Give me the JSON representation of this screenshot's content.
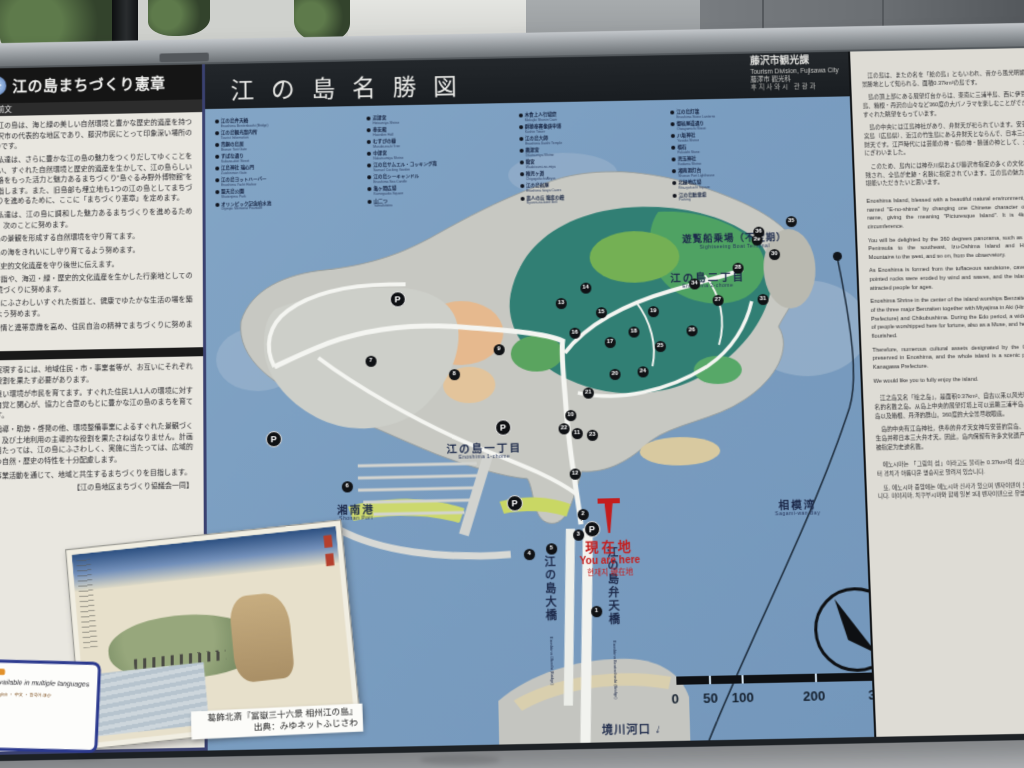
{
  "colors": {
    "sea": "#7a9dc0",
    "band_dark": "#1b1f23",
    "accent_red": "#c41d1d",
    "navy_text": "#1d2a4a",
    "paper": "#e9e7e0"
  },
  "left_panel": {
    "emblem": "❉",
    "title": "江の島まちづくり憲章",
    "section_label": "1　前文",
    "preamble": [
      "　江の島は、海と緑の美しい自然環境と豊かな歴史的遺産を持つ藤沢市の代表的な地区であり、藤沢市民にとって印象深い場所の1つです。",
      "　私達は、さらに豊かな江の島の魅力をつくりだしてゆくことを願い、すぐれた自然環境と歴史的遺産を生かして、江の島らしい風格をもった活力と魅力あるまちづくり“島ぐるみ野外博物館”を目指します。また、旧島部も埋立地も1つの江の島としてまちづくりを進めるために、ここに「まちづくり憲章」を定めます。",
      "　私達は、江の島に調和した魅力あるまちづくりを進めるために、次のことに努めます。"
    ],
    "goals": [
      "●島の景観を形成する自然環境を守り育てます。",
      "●島の海をきれいにし守り育てるよう努めます。",
      "●歴史的文化遺産を守り後世に伝えます。",
      "●参詣や、海辺・緑・歴史的文化遺産を生かした行楽地としての環境づくりに努めます。",
      "●島にふさわしいすぐれた街並と、健康でゆたかな生活の場を築くよう努めます。",
      "●愛情と連帯意識を高め、住民自治の精神でまちづくりに努めます。"
    ],
    "section2": [
      "　実現するには、地域住民・市・事業者等が、お互いにそれぞれの役割を果たす必要があります。",
      "　良い環境が市民を育てます。すぐれた住民1人1人の環境に対する自覚と関心が、協力と合意のもとに豊かな江の島のまちを育てます。",
      "　指導・助勢・啓発の他、環境整備事業によるすぐれた景観づくり、及び土地利用の主導的な役割を果たさねばなりません。計画に当たっては、江の島にふさわしく、実施に当たっては、広域的かつ自然・歴史の特性を十分配慮します。",
      "　事業活動を通じて、地域と共生するまちづくりを目指します。"
    ],
    "signature": "【江の島地区まちづくり協議会一同】",
    "multilingual_box": {
      "line1": "Available in multiple languages",
      "line2": "English ・ 中文 ・ 한국어 ほか"
    }
  },
  "map_panel": {
    "title": "江の島名勝図",
    "credits": {
      "jp": "藤沢市観光課",
      "en": "Tourism Division, Fujisawa City",
      "zh": "藤澤市 觀光科",
      "kr": "후지사와시  관광과"
    },
    "legend": {
      "columns": [
        {
          "items": [
            {
              "jp": "江の島弁天橋",
              "en": "Enoshima Bentenbashi (Bridge)"
            },
            {
              "jp": "江の島観光案内所",
              "en": "Tourist Information"
            },
            {
              "jp": "青銅の鳥居",
              "en": "Bronze Torii Gate"
            },
            {
              "jp": "すばな通り",
              "en": "Subana-dori Street"
            },
            {
              "jp": "江島神社 瑞心門",
              "en": "Zuishinmon Gate"
            },
            {
              "jp": "江の島ヨットハーバー",
              "en": "Enoshima Yacht Harbor"
            },
            {
              "jp": "聖天島公園",
              "en": "Shotenjima Park"
            },
            {
              "jp": "オリンピック記念噴水池",
              "en": "Olympic Memorial Fountain"
            }
          ]
        },
        {
          "items": [
            {
              "jp": "辺津宮",
              "en": "Hetsumiya Shrine"
            },
            {
              "jp": "奉安殿",
              "en": "Hoanden Hall"
            },
            {
              "jp": "むすびの樹",
              "en": "Musubi-no-ki Tree"
            },
            {
              "jp": "中津宮",
              "en": "Nakatsumiya Shrine"
            },
            {
              "jp": "江の島サムエル・コッキング苑",
              "en": "Samuel Cocking Garden"
            },
            {
              "jp": "江の島シーキャンドル",
              "en": "Enoshima Sea Candle"
            },
            {
              "jp": "亀ヶ岡広場",
              "en": "Kamegaoka Square"
            },
            {
              "jp": "山二つ",
              "en": "Yamafutatsu"
            }
          ]
        },
        {
          "items": [
            {
              "jp": "木食上人行場窟",
              "en": "Mokujiki Shonin Cave"
            },
            {
              "jp": "群猿奉賽像庚申塔",
              "en": "Koshin Tower"
            },
            {
              "jp": "江の島大師",
              "en": "Enoshima Daishi Temple"
            },
            {
              "jp": "奥津宮",
              "en": "Okutsumiya Shrine"
            },
            {
              "jp": "龍宮",
              "en": "Wadatsumi-no-miya"
            },
            {
              "jp": "稚児ヶ淵",
              "en": "Chigogafuchi Abyss"
            },
            {
              "jp": "江の島岩屋",
              "en": "Enoshima Iwaya Caves"
            },
            {
              "jp": "恋人の丘 龍恋の鐘",
              "en": "Ryuren-no-kane Bell"
            }
          ]
        },
        {
          "items": [
            {
              "jp": "江の島灯籠",
              "en": "Enoshima Stone Lanterns"
            },
            {
              "jp": "御岩屋道通り",
              "en": "Oiwayamichi Street"
            },
            {
              "jp": "八坂神社",
              "en": "Yasaka Shrine"
            },
            {
              "jp": "福石",
              "en": "Fukuishi Stone"
            },
            {
              "jp": "児玉神社",
              "en": "Kodama Shrine"
            },
            {
              "jp": "湘南港灯台",
              "en": "Shonan Port Lighthouse"
            },
            {
              "jp": "北緑地広場",
              "en": "Kita-ryokuchi Square"
            },
            {
              "jp": "江の島駐車場",
              "en": "Parking"
            }
          ]
        }
      ]
    },
    "labels": {
      "district1": {
        "jp": "江の島一丁目",
        "en": "Enoshima 1-chome"
      },
      "district2": {
        "jp": "江の島二丁目",
        "en": "Enoshima 2-chome"
      },
      "port": {
        "jp": "湘南港",
        "en": "Shonan Port"
      },
      "bay": {
        "jp": "相模湾",
        "en": "Sagami-wan Bay"
      },
      "boat": {
        "jp": "遊覧船乗場（不定期）",
        "en": "Sightseeing Boat Terminal"
      },
      "river": {
        "jp": "境川河口",
        "arrow": "↓"
      },
      "bridge_left": {
        "jp": "江の島大橋",
        "en": "Enoshima Ohashi (Bridge)"
      },
      "bridge_right": {
        "jp": "江の島弁天橋",
        "en": "Enoshima Bentenbashi (Bridge)"
      }
    },
    "you_are_here": {
      "jp": "現在地",
      "en": "You are here",
      "multi": "현재지  現在地"
    },
    "compass_label": "N",
    "scale": {
      "ticks": [
        {
          "t": "0",
          "x": 455
        },
        {
          "t": "50",
          "x": 486
        },
        {
          "t": "100",
          "x": 514
        },
        {
          "t": "200",
          "x": 584
        },
        {
          "t": "300m",
          "x": 648
        }
      ]
    },
    "parking_label": "P",
    "markers": [
      {
        "n": "1",
        "x": 378,
        "y": 550
      },
      {
        "n": "2",
        "x": 367,
        "y": 455
      },
      {
        "n": "3",
        "x": 362,
        "y": 475
      },
      {
        "n": "4",
        "x": 313,
        "y": 493
      },
      {
        "n": "5",
        "x": 335,
        "y": 488
      },
      {
        "n": "6",
        "x": 134,
        "y": 423
      },
      {
        "n": "7",
        "x": 159,
        "y": 299
      },
      {
        "n": "8",
        "x": 242,
        "y": 314
      },
      {
        "n": "9",
        "x": 287,
        "y": 290
      },
      {
        "n": "10",
        "x": 357,
        "y": 357
      },
      {
        "n": "11",
        "x": 363,
        "y": 375
      },
      {
        "n": "12",
        "x": 360,
        "y": 415
      },
      {
        "n": "13",
        "x": 350,
        "y": 245
      },
      {
        "n": "14",
        "x": 375,
        "y": 230
      },
      {
        "n": "15",
        "x": 390,
        "y": 255
      },
      {
        "n": "16",
        "x": 363,
        "y": 275
      },
      {
        "n": "17",
        "x": 398,
        "y": 285
      },
      {
        "n": "18",
        "x": 422,
        "y": 275
      },
      {
        "n": "19",
        "x": 442,
        "y": 255
      },
      {
        "n": "20",
        "x": 402,
        "y": 317
      },
      {
        "n": "21",
        "x": 375,
        "y": 335
      },
      {
        "n": "22",
        "x": 350,
        "y": 370
      },
      {
        "n": "23",
        "x": 378,
        "y": 377
      },
      {
        "n": "24",
        "x": 430,
        "y": 315
      },
      {
        "n": "25",
        "x": 448,
        "y": 290
      },
      {
        "n": "26",
        "x": 480,
        "y": 275
      },
      {
        "n": "27",
        "x": 507,
        "y": 245
      },
      {
        "n": "28",
        "x": 528,
        "y": 213
      },
      {
        "n": "29",
        "x": 548,
        "y": 185
      },
      {
        "n": "30",
        "x": 565,
        "y": 200
      },
      {
        "n": "31",
        "x": 552,
        "y": 245
      },
      {
        "n": "34",
        "x": 484,
        "y": 228
      },
      {
        "n": "35",
        "x": 583,
        "y": 167
      },
      {
        "n": "36",
        "x": 550,
        "y": 177
      }
    ],
    "parking": [
      {
        "label": "P",
        "x": 184,
        "y": 235
      },
      {
        "label": "P",
        "x": 59,
        "y": 372
      },
      {
        "label": "P",
        "x": 287,
        "y": 365
      },
      {
        "label": "P",
        "x": 297,
        "y": 440
      },
      {
        "label": "P",
        "x": 373,
        "y": 467
      }
    ]
  },
  "ukiyoe": {
    "caption_line1": "葛飾北斎『冨嶽三十六景 相州江の島』",
    "caption_line2": "出典：みゆネットふじさわ"
  },
  "right_panel": {
    "jp": [
      "　江の島は、またの名を「絵の島」ともいわれ、昔から風光明媚な景勝地として知られる、面積0.37km²の島です。",
      "　島の頂上部にある展望灯台からは、東南に三浦半島、西に伊豆大島、箱根・丹沢の山々など360度の大パノラマを楽しむことができ、すぐれた眺望をもっています。",
      "　島の中央には江島神社があり、弁財天が祀られています。安芸の宮島（広島県）、近江の竹生島にある弁財天とならんで、日本三大弁財天です。江戸時代には芸能の神・福の神・勝運の神として、大変にぎわいました。",
      "　このため、島内には神奈川県および藤沢市指定の多くの文化財が残され、全島が史跡・名勝に指定されています。江の島の魅力をご堪能いただきたいと思います。"
    ],
    "en": [
      "Enoshima Island, blessed with a beautiful natural environment, was named \"E-no-shima\" by changing one Chinese character of the name, giving the meaning \"Picturesque Island\". It is 4km in circumference.",
      "You will be delighted by the 360 degrees panorama, such as Miura Peninsula to the southeast, Izu-Oshima Island and Hakone Mountains to the west, and so on, from the observatory.",
      "As Enoshima is formed from the tuffaceous sandstone, caves and pointed rocks were eroded by wind and waves, and the island has attracted people for ages.",
      "Enoshima Shrine in the center of the island worships Benzaiten, one of the three major Benzaiten together with Miyajima in Aki (Hiroshima Prefecture) and Chikubushima. During the Edo period, a wide range of people worshipped here for fortune, also as a Muse, and here they flourished.",
      "Therefore, numerous cultural assets designated by the City are preserved in Enoshima, and the whole island is a scenic place by Kanagawa Prefecture.",
      "We would like you to fully enjoy the island."
    ],
    "zh": [
      "　江之岛又名「绘之岛」，是面积0.37km²、自古以来以风光明媚而闻名的名胜之岛。从岛上中央的展望灯塔上可以远眺三浦半岛、伊豆大岛以及箱根、丹泽的群山，360度的大全景尽收眼底。",
      "　岛的中央有江岛神社，供奉的弁才天女神与安芸的宫岛、近江的竹生岛并称日本三大弁才天。因此，岛内保留有许多文化遗产，全岛又被指定为史迹名胜。"
    ],
    "kr": [
      "　에노시마는 「그림의 섬」이라고도 불리는 0.37km²의 섬으로, 옛날부터 경치가 아름다운 명승지로 알려져 있습니다.",
      "　또, 에노시마 중앙에는 에노시마 신사가 있으며 벤자이텐이 모셔져 있습니다. 미야지마, 치쿠부시마와 함께 일본 3대 벤자이텐으로 유명합니다."
    ]
  }
}
